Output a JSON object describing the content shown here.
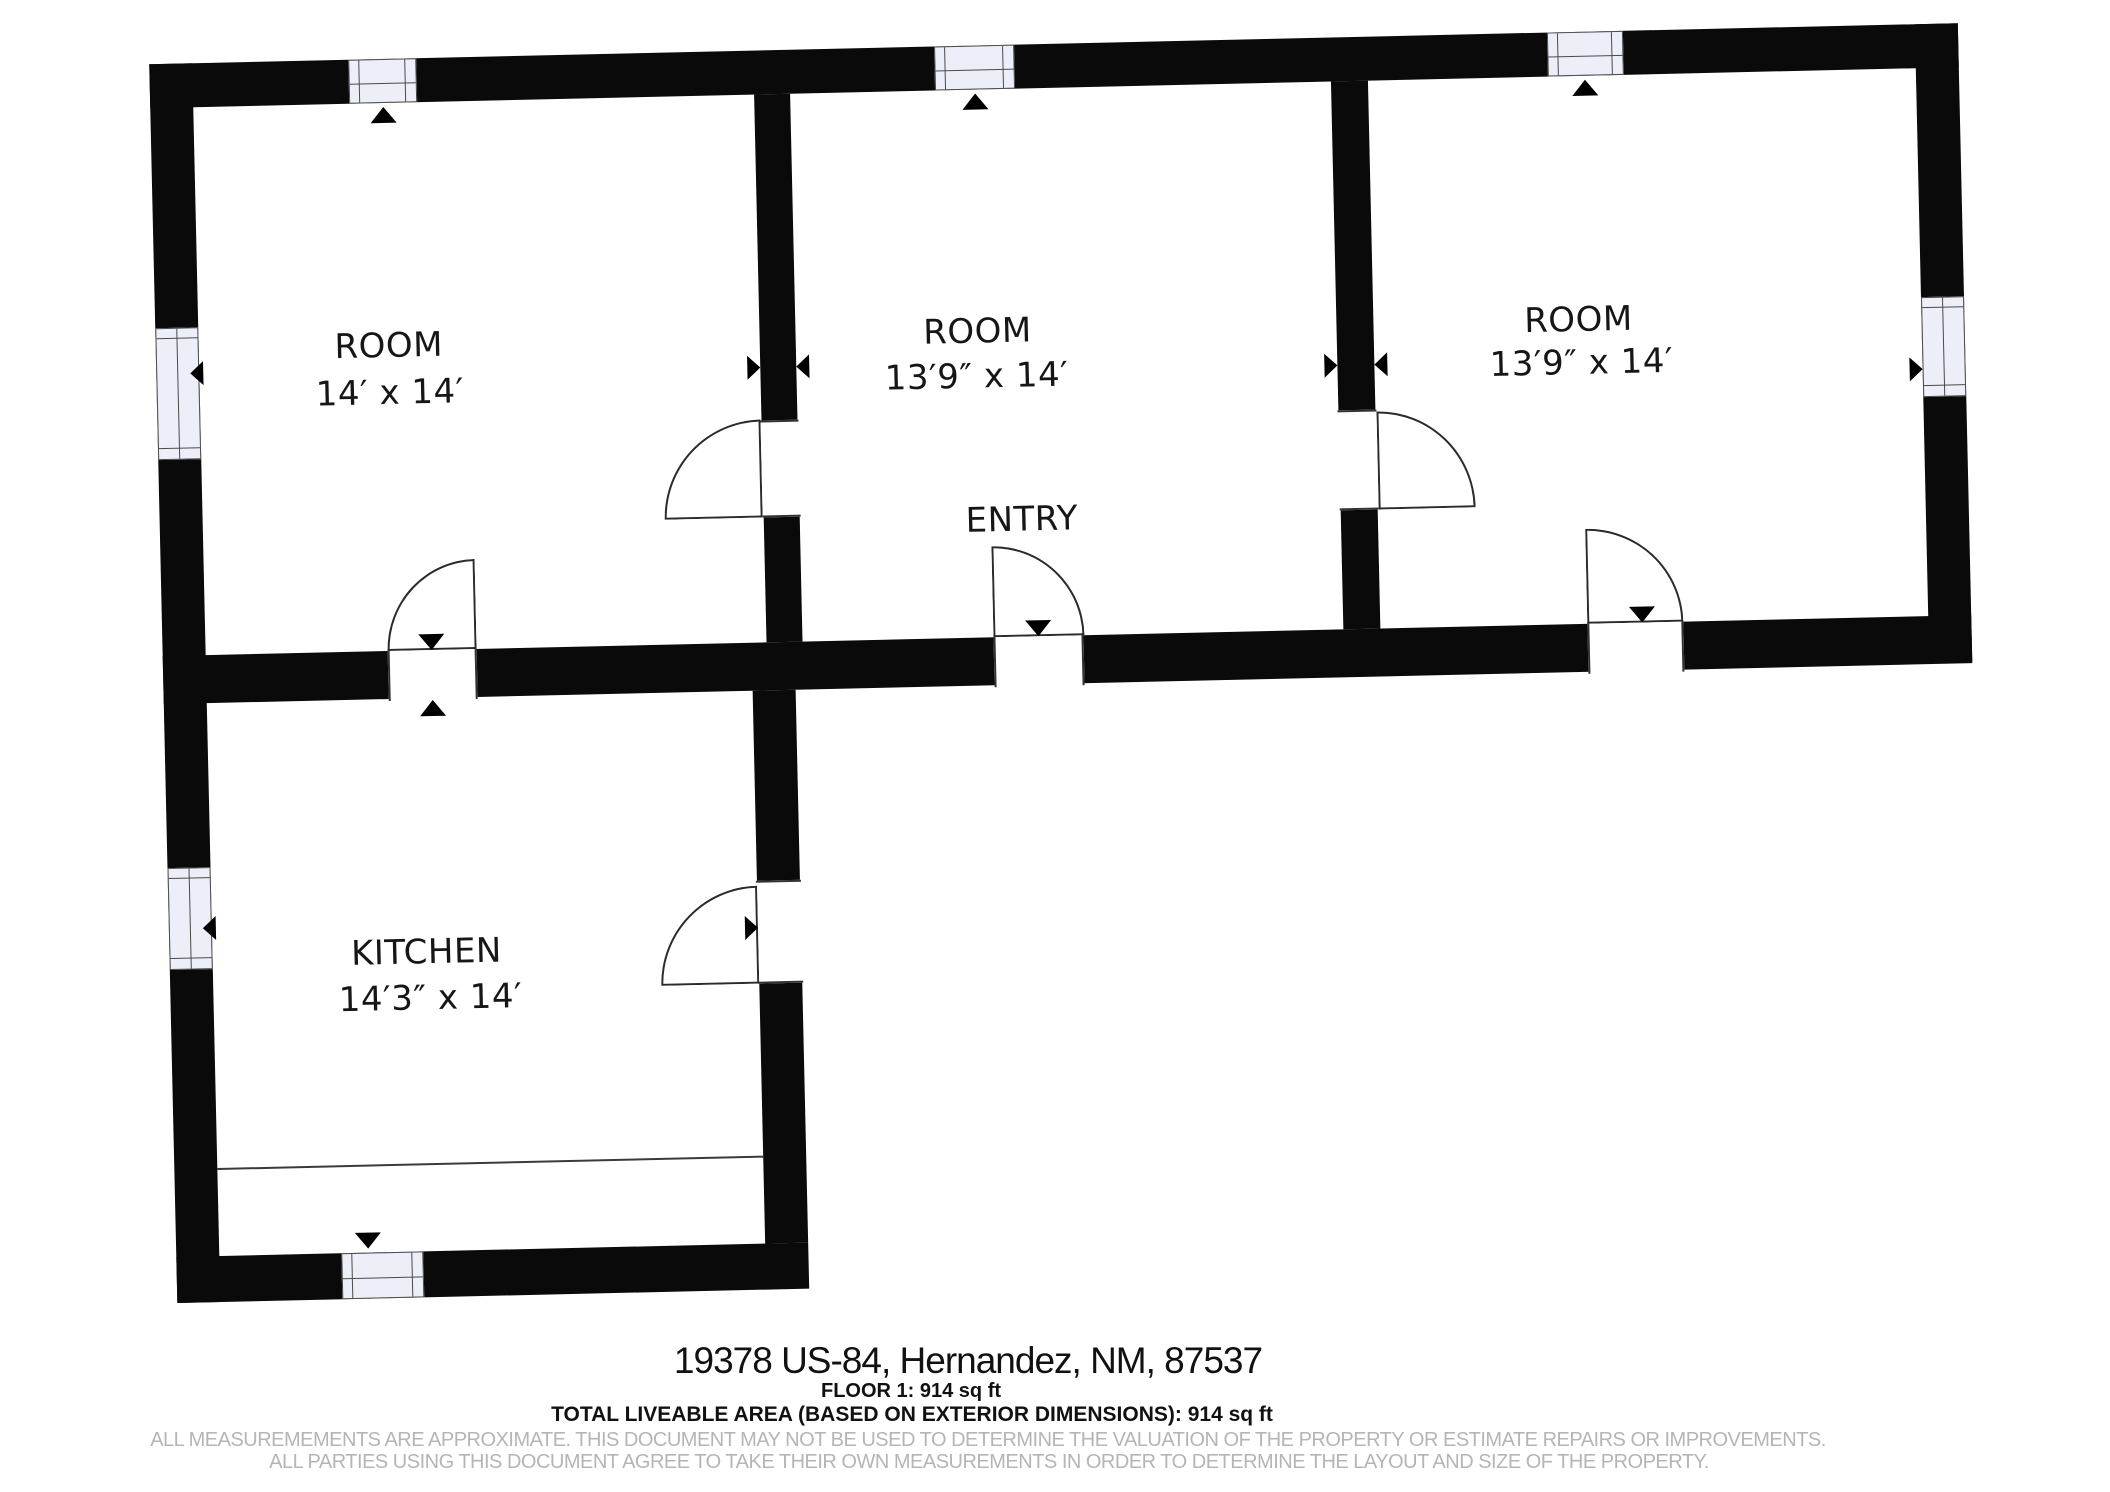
{
  "plan": {
    "rooms": [
      {
        "name": "ROOM",
        "dims": "14′ x 14′"
      },
      {
        "name": "ROOM",
        "dims": "13′9″ x 14′"
      },
      {
        "name": "ROOM",
        "dims": "13′9″ x 14′"
      },
      {
        "name": "KITCHEN",
        "dims": "14′3″ x 14′"
      }
    ],
    "entry_label": "ENTRY"
  },
  "footer": {
    "address": "19378 US-84, Hernandez, NM, 87537",
    "floor_area": "FLOOR 1: 914 sq ft",
    "total_area": "TOTAL LIVEABLE AREA (BASED ON EXTERIOR DIMENSIONS): 914 sq ft",
    "disclaimer_line1": "ALL MEASUREMEMENTS ARE APPROXIMATE. THIS DOCUMENT MAY NOT BE USED TO DETERMINE THE VALUATION OF THE PROPERTY OR ESTIMATE REPAIRS OR IMPROVEMENTS.",
    "disclaimer_line2": "ALL PARTIES USING THIS DOCUMENT AGREE TO TAKE THEIR OWN MEASUREMENTS IN ORDER TO DETERMINE THE LAYOUT AND SIZE OF THE PROPERTY."
  },
  "colors": {
    "wall": "#0a0a0a",
    "window_fill": "#edeff8",
    "line": "#2b2b2b",
    "disclaimer_text": "#b5b5b5"
  }
}
